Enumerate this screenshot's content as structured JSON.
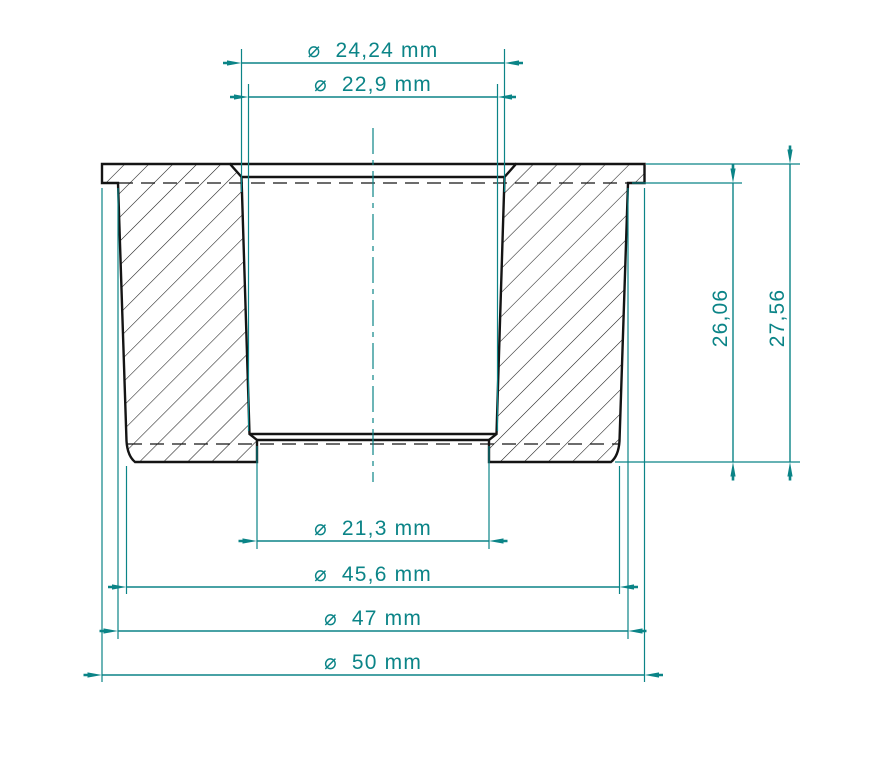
{
  "drawing": {
    "kind": "cross-section of tapered bushing with flange",
    "background_color": "#ffffff",
    "outline_color": "#141414",
    "dimension_color": "#0b8487",
    "hatch_angle_deg": 45,
    "diameter_symbol": "⌀",
    "decimal_separator": ","
  },
  "dims": {
    "d24_24": {
      "label": "⌀  24,24 mm",
      "value": "24,24",
      "unit": "mm",
      "orientation": "horizontal",
      "feature": "bore top chamfer diameter"
    },
    "d22_9": {
      "label": "⌀  22,9 mm",
      "value": "22,9",
      "unit": "mm",
      "orientation": "horizontal",
      "feature": "tapered bore diameter"
    },
    "d21_3": {
      "label": "⌀  21,3 mm",
      "value": "21,3",
      "unit": "mm",
      "orientation": "horizontal",
      "feature": "bottom recess diameter"
    },
    "d45_6": {
      "label": "⌀  45,6 mm",
      "value": "45,6",
      "unit": "mm",
      "orientation": "horizontal",
      "feature": "outer body diameter at bottom"
    },
    "d47": {
      "label": "⌀  47 mm",
      "value": "47",
      "unit": "mm",
      "orientation": "horizontal",
      "feature": "outer body diameter at top"
    },
    "d50": {
      "label": "⌀  50 mm",
      "value": "50",
      "unit": "mm",
      "orientation": "horizontal",
      "feature": "flange outer diameter"
    },
    "h26_06": {
      "label": "26,06",
      "value": "26,06",
      "unit": "",
      "orientation": "vertical",
      "feature": "height below flange lip"
    },
    "h27_56": {
      "label": "27,56",
      "value": "27,56",
      "unit": "",
      "orientation": "vertical",
      "feature": "total height"
    }
  }
}
